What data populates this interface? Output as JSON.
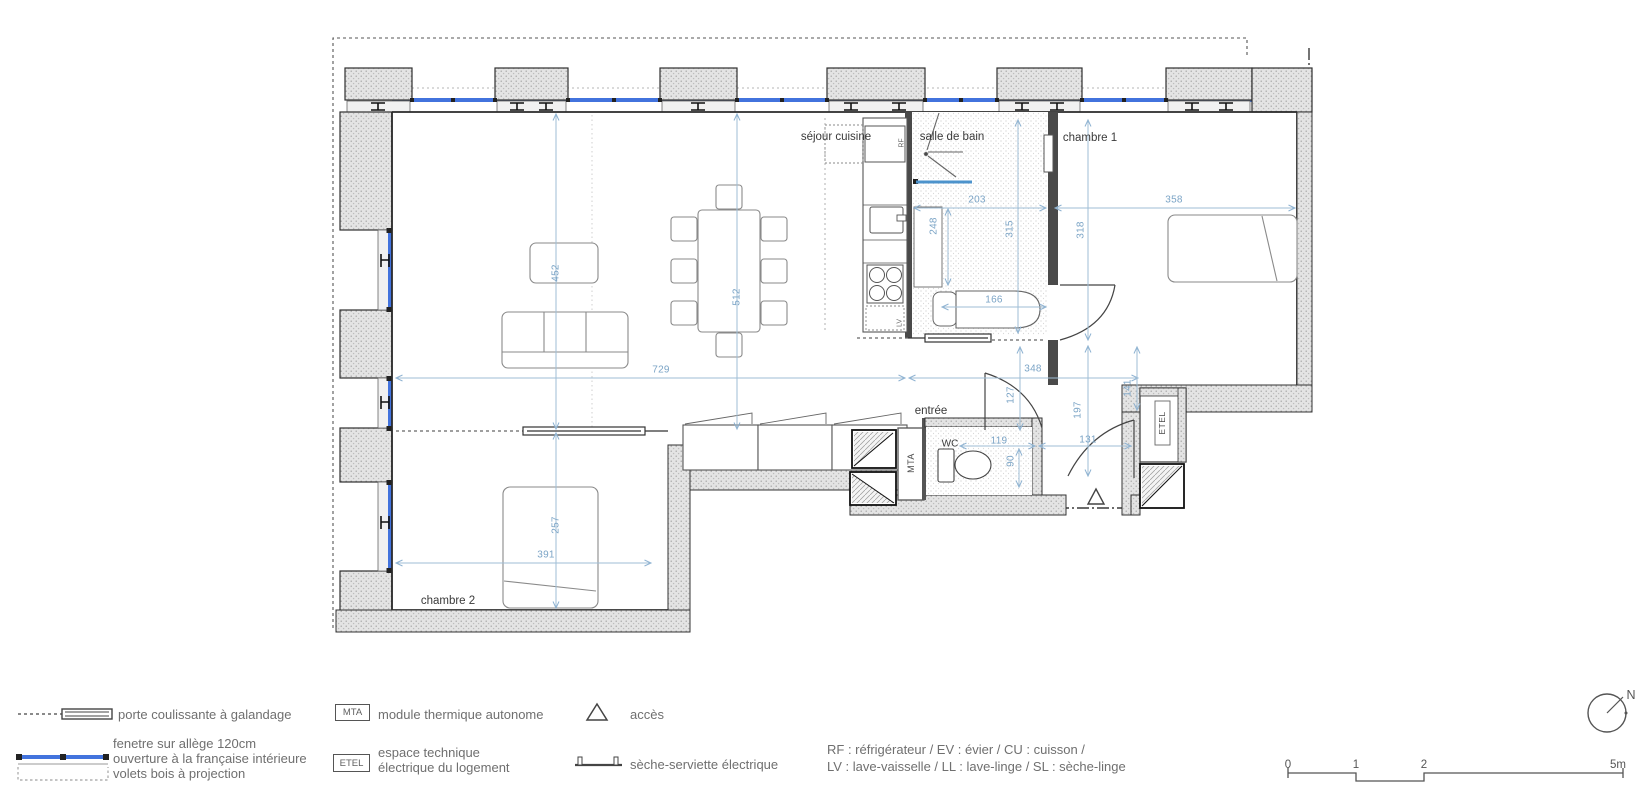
{
  "rooms": {
    "living": "séjour cuisine",
    "bath": "salle de bain",
    "bedroom1": "chambre 1",
    "bedroom2": "chambre 2",
    "entry": "entrée",
    "wc": "WC"
  },
  "plan_labels": {
    "mta": "MTA",
    "etel": "ETEL",
    "rf": "RF",
    "lv": "LV"
  },
  "dims": {
    "living_vertical": "452",
    "dining_vertical": "512",
    "corridor_left": "729",
    "corridor_right": "348",
    "bath_width": "203",
    "bath_counter": "248",
    "bath_height": "315",
    "bath_lower": "166",
    "bedroom1_width": "358",
    "bedroom1_height": "318",
    "hall_upper": "127",
    "hall_mid": "197",
    "hall_right": "141",
    "hall_lower": "131",
    "wc_width": "119",
    "wc_depth": "90",
    "bedroom2_height": "257",
    "bedroom2_width": "391"
  },
  "legend": {
    "sliding_door": "porte coulissante à galandage",
    "window_line1": "fenetre sur allège 120cm",
    "window_line2": "ouverture à la française intérieure",
    "window_line3": "volets bois à projection",
    "mta_key": "MTA",
    "mta_label": "module thermique autonome",
    "etel_key": "ETEL",
    "etel_line1": "espace technique",
    "etel_line2": "électrique du logement",
    "access_label": "accès",
    "towel_label": "sèche-serviette électrique",
    "abbrev_line1": "RF : réfrigérateur / EV : évier / CU : cuisson /",
    "abbrev_line2": "LV : lave-vaisselle / LL : lave-linge / SL : sèche-linge"
  },
  "scalebar": {
    "t0": "0",
    "t1": "1",
    "t2": "2",
    "t5": "5m"
  },
  "north": {
    "label": "N"
  },
  "colors": {
    "window_blue": "#4273dd",
    "dim_blue": "#7ba4c6",
    "wall_stroke": "#2f2f2f",
    "dash_dot": "#3a3a3a"
  }
}
